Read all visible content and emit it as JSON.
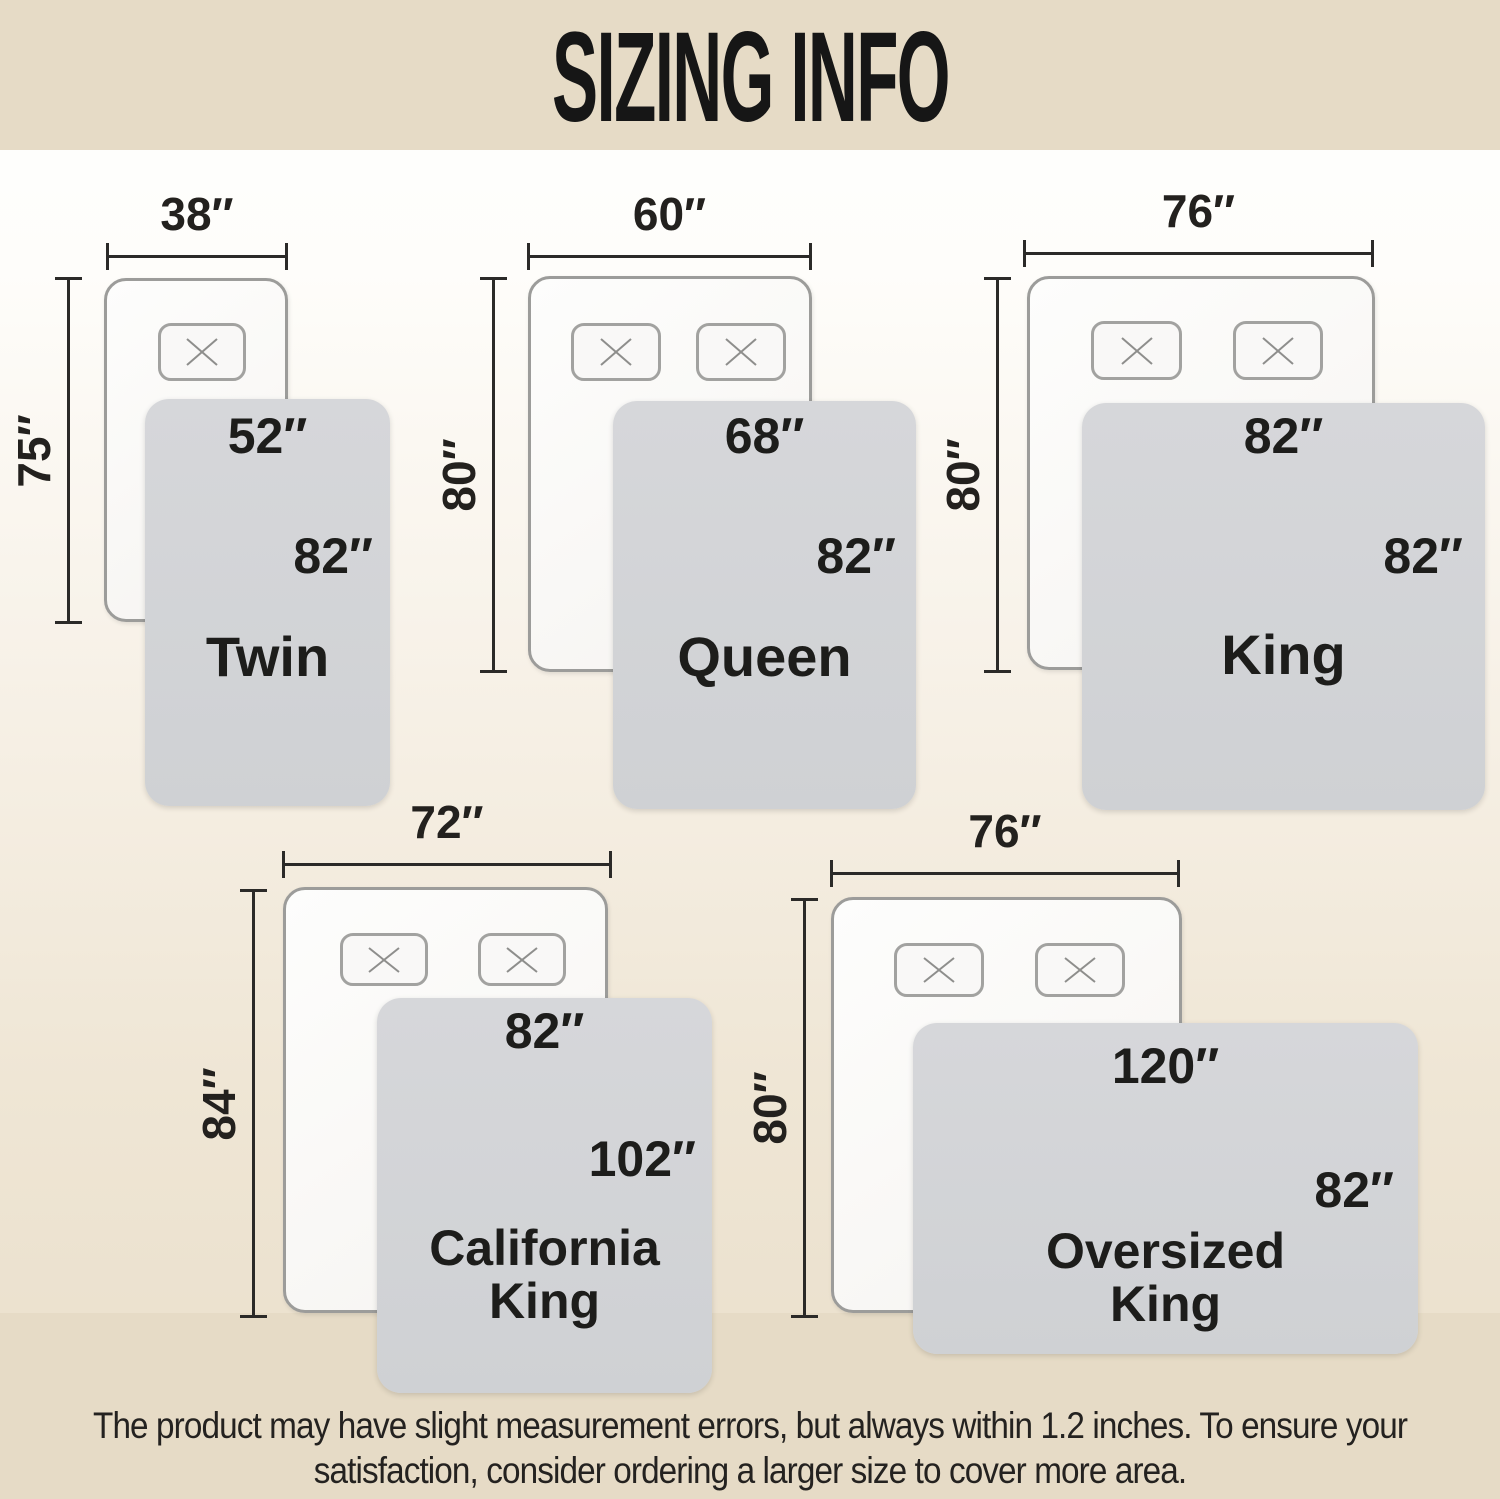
{
  "title": "SIZING INFO",
  "footer": {
    "line1": "The product may have slight measurement errors, but always within 1.2 inches. To ensure your",
    "line2": "satisfaction, consider ordering a larger size to cover more area."
  },
  "sizes": [
    {
      "name": "Twin",
      "bed_width": "38″",
      "bed_length": "75″",
      "blanket_width": "52″",
      "blanket_length": "82″",
      "pillow_count": 1
    },
    {
      "name": "Queen",
      "bed_width": "60″",
      "bed_length": "80″",
      "blanket_width": "68″",
      "blanket_length": "82″",
      "pillow_count": 2
    },
    {
      "name": "King",
      "bed_width": "76″",
      "bed_length": "80″",
      "blanket_width": "82″",
      "blanket_length": "82″",
      "pillow_count": 2
    },
    {
      "name": "California King",
      "bed_width": "72″",
      "bed_length": "84″",
      "blanket_width": "82″",
      "blanket_length": "102″",
      "pillow_count": 2
    },
    {
      "name": "Oversized King",
      "bed_width": "76″",
      "bed_length": "80″",
      "blanket_width": "120″",
      "blanket_length": "82″",
      "pillow_count": 2
    }
  ],
  "colors": {
    "banner": "#e6dbc6",
    "background_top": "#ffffff",
    "background_bottom": "#e9deca",
    "blanket": "#d2d3d6",
    "bed_fill": "#fbfaf8",
    "bed_border": "#9c9c9a",
    "dimension_line": "#2b2a28",
    "text": "#1d1d1b"
  }
}
